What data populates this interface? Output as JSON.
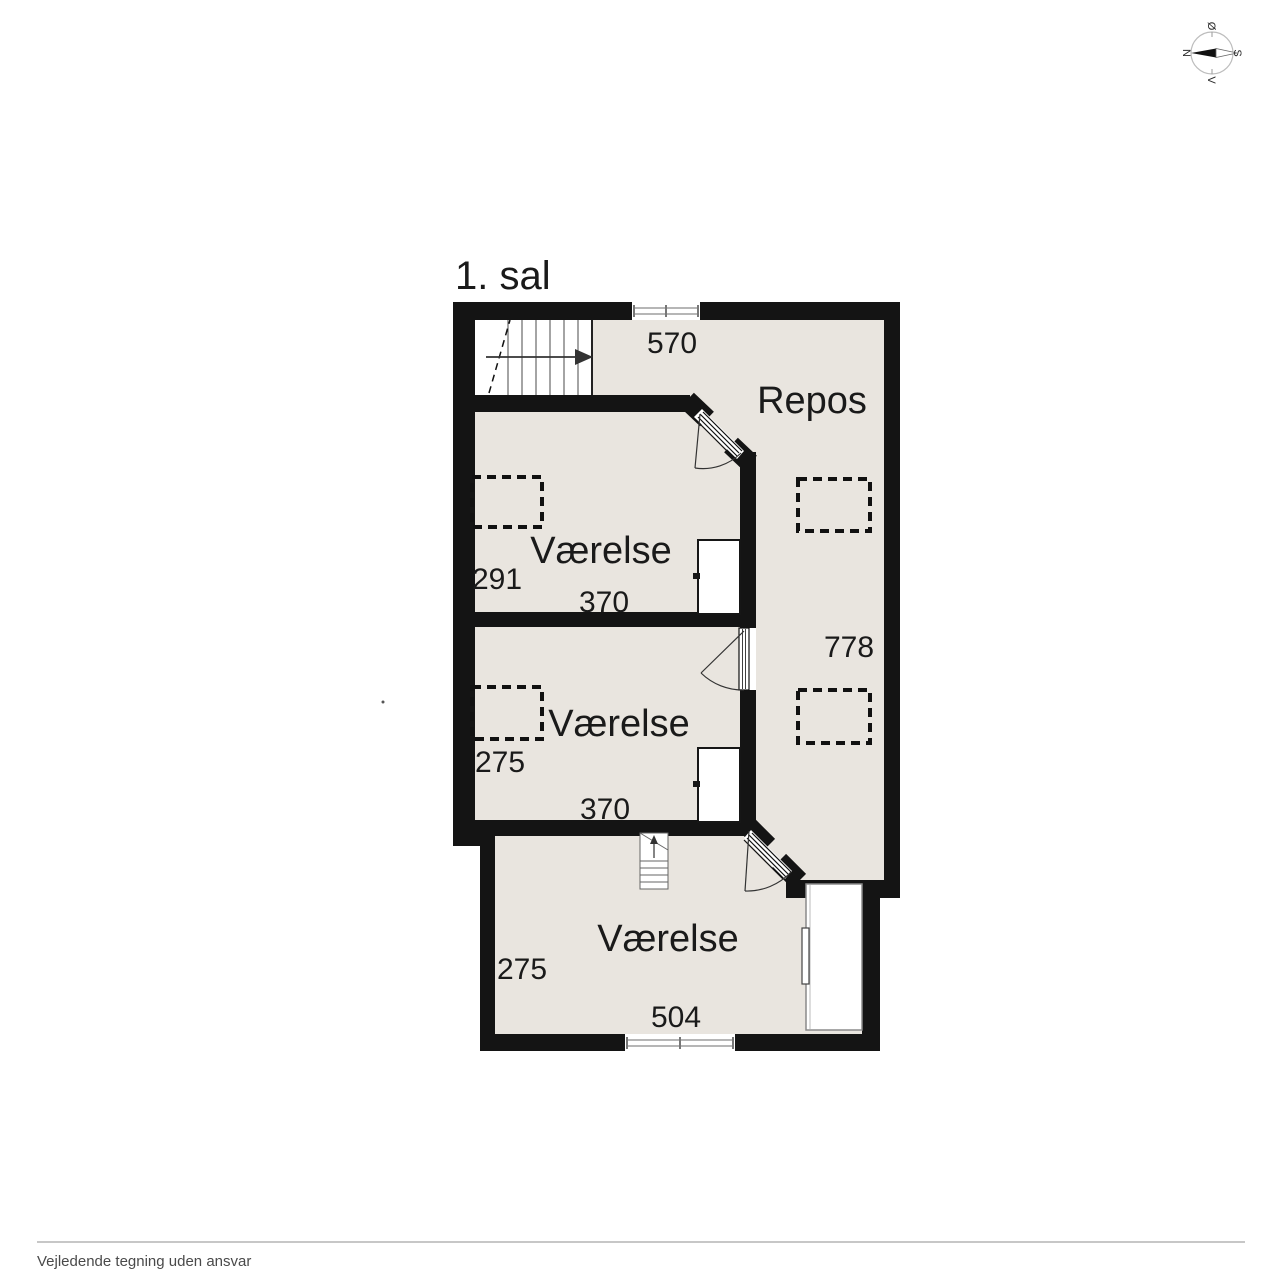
{
  "title": "1. sal",
  "rooms": {
    "repos": {
      "name": "Repos",
      "width": "570",
      "depth": "778"
    },
    "vaerelse_top": {
      "name": "Værelse",
      "depth": "291",
      "width": "370"
    },
    "vaerelse_mid": {
      "name": "Værelse",
      "depth": "275",
      "width": "370"
    },
    "vaerelse_bottom": {
      "name": "Værelse",
      "depth": "275",
      "width": "504"
    }
  },
  "compass": {
    "north": "N",
    "south": "S",
    "east": "Ø",
    "west": "V"
  },
  "footer": {
    "disclaimer": "Vejledende tegning uden ansvar"
  },
  "colors": {
    "wall": "#141414",
    "floor": "#e9e5df",
    "background": "#ffffff"
  }
}
